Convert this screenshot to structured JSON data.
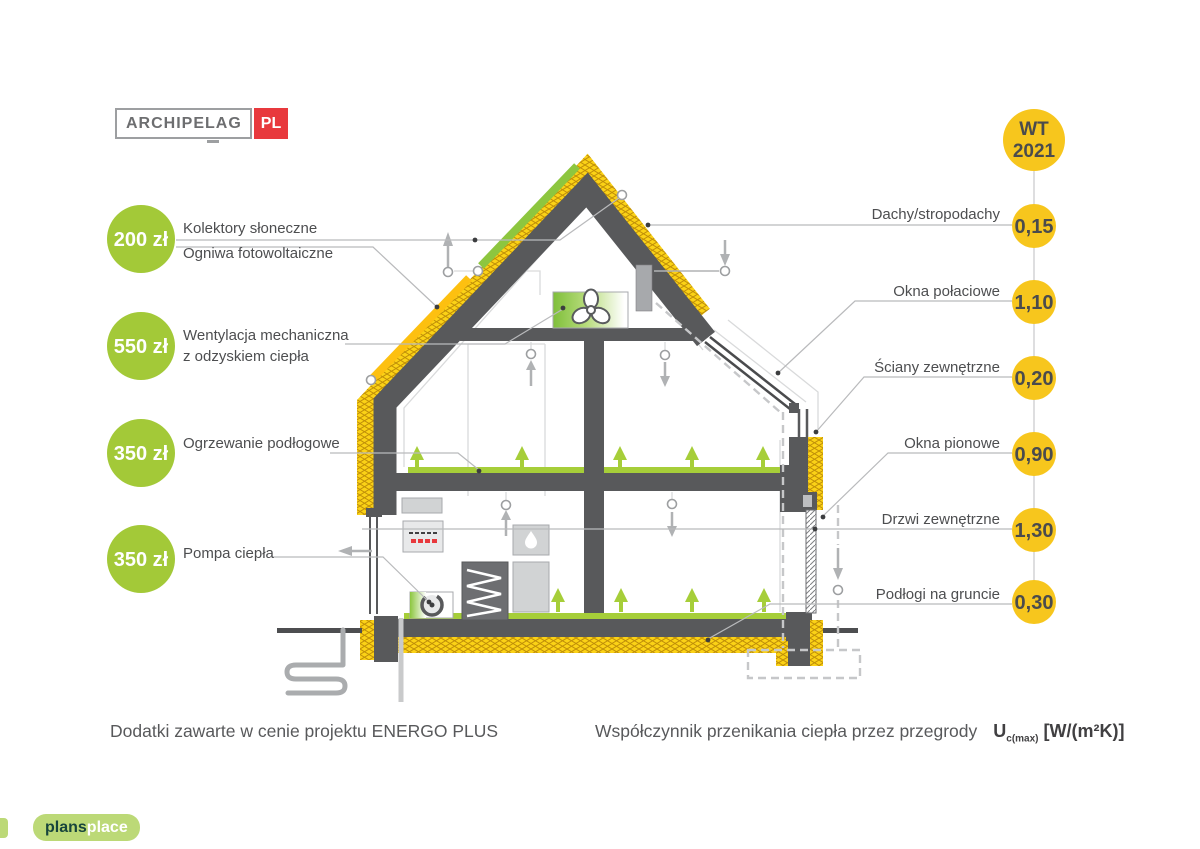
{
  "logos": {
    "archipelag": "ARCHIPELAG",
    "pl": "PL",
    "plans": "plans",
    "place": "place"
  },
  "left_items": [
    {
      "price": "200 zł",
      "label_1": "Kolektory słoneczne",
      "label_2": "Ogniwa fotowoltaiczne"
    },
    {
      "price": "550 zł",
      "label_1": "Wentylacja mechaniczna",
      "label_2": "z odzyskiem ciepła"
    },
    {
      "price": "350 zł",
      "label_1": "Ogrzewanie podłogowe",
      "label_2": ""
    },
    {
      "price": "350 zł",
      "label_1": "Pompa ciepła",
      "label_2": ""
    }
  ],
  "wt_badge": {
    "line1": "WT",
    "line2": "2021"
  },
  "right_items": [
    {
      "label": "Dachy/stropodachy",
      "value": "0,15"
    },
    {
      "label": "Okna połaciowe",
      "value": "1,10"
    },
    {
      "label": "Ściany zewnętrzne",
      "value": "0,20"
    },
    {
      "label": "Okna pionowe",
      "value": "0,90"
    },
    {
      "label": "Drzwi zewnętrzne",
      "value": "1,30"
    },
    {
      "label": "Podłogi na gruncie",
      "value": "0,30"
    }
  ],
  "captions": {
    "left": "Dodatki zawarte w cenie projektu ENERGO PLUS",
    "right": "Współczynnik przenikania ciepła przez przegrody",
    "u": "U",
    "u_sub": "c(max)",
    "units": "[W/(m²K)]"
  },
  "colors": {
    "accent_green": "#a3c938",
    "accent_yellow": "#f7c61d",
    "structure_gray": "#58595b",
    "insulation_yellow": "#fbd216",
    "heating_green": "#a6ce39",
    "brand_red": "#e8393d"
  }
}
